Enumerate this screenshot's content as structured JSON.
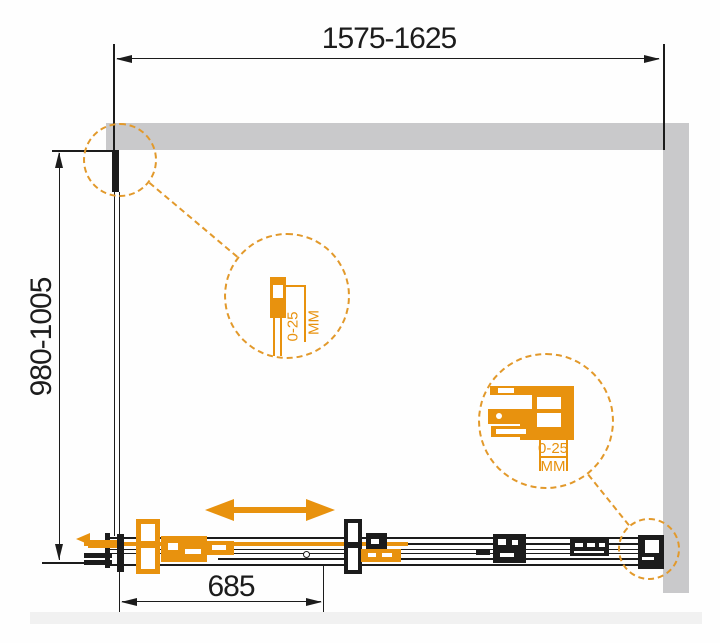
{
  "drawing": {
    "type": "shower-enclosure-technical-drawing",
    "labels": {
      "width": "1575-1625",
      "height": "980-1005",
      "door": "685"
    },
    "details": {
      "profile": {
        "range": "0-25",
        "unit": "MM"
      },
      "roller": {
        "range": "0-25",
        "unit": "MM"
      }
    },
    "icons": {
      "slide_arrow": "double-headed-arrow",
      "detail_callouts": "dashed-circle"
    },
    "colors": {
      "accent_orange": "#E8920E",
      "dash_orange": "#E2992B",
      "wall_gray": "#C9C9CB",
      "floor_gray": "#F1F1F1",
      "line_black": "#1C1C1C"
    }
  }
}
